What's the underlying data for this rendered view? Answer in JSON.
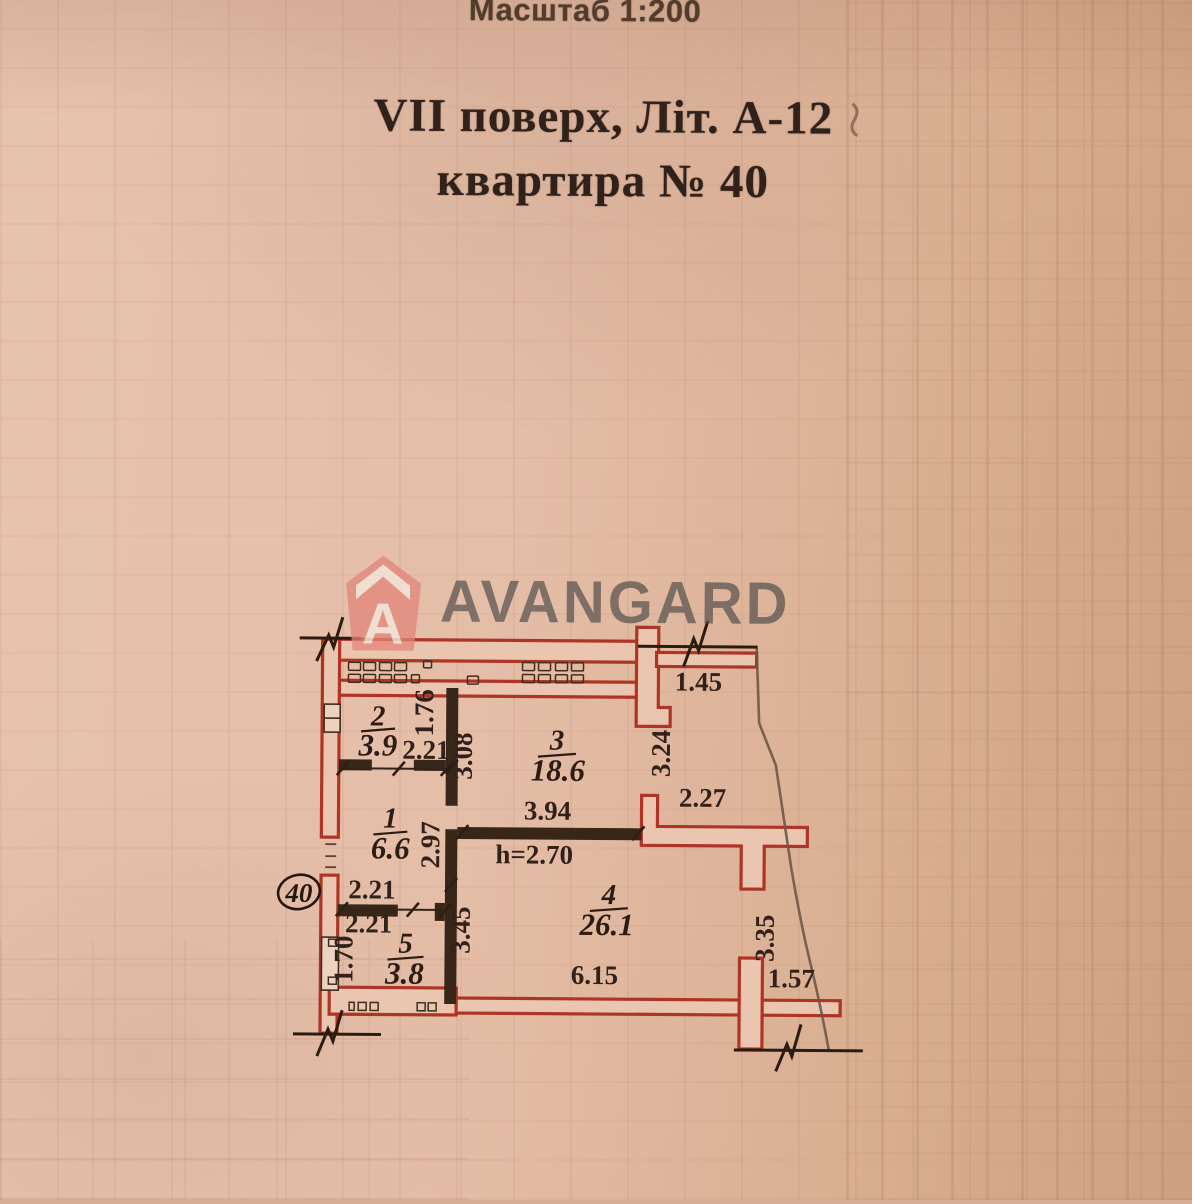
{
  "header": {
    "scale_label": "Масштаб 1:200",
    "title_line1": "VII поверх, Літ. А-12",
    "title_line2": "квартира № 40"
  },
  "watermark": {
    "brand": "AVANGARD",
    "icon_letter": "A",
    "icon": "avangard-house-icon"
  },
  "plan": {
    "apartment_badge": "40",
    "ceiling_height": "h=2.70",
    "rooms": [
      {
        "number": "1",
        "area": "6.6"
      },
      {
        "number": "2",
        "area": "3.9"
      },
      {
        "number": "3",
        "area": "18.6"
      },
      {
        "number": "4",
        "area": "26.1"
      },
      {
        "number": "5",
        "area": "3.8"
      }
    ],
    "dimensions": {
      "balcony_top_width": "1.45",
      "balcony_top_depth": "3.24",
      "room2_right_wall": "1.76",
      "room2_width": "2.21",
      "room3_left_depth": "3.08",
      "room3_width": "3.94",
      "hall_depth": "2.97",
      "niche_width": "2.27",
      "room5_width_upper": "2.21",
      "room5_width_lower": "2.21",
      "room5_left_depth": "1.70",
      "room4_left_depth": "3.45",
      "room4_width": "6.15",
      "balcony_right_depth": "3.35",
      "balcony_bottom_width": "1.57"
    }
  },
  "colors": {
    "paper": "#e3bba5",
    "wall_red": "#ae3526",
    "partition_dark": "#382718",
    "ink_dark": "#2f2015",
    "watermark_text": "#7d7674",
    "logo_salmon": "#e2857a"
  }
}
